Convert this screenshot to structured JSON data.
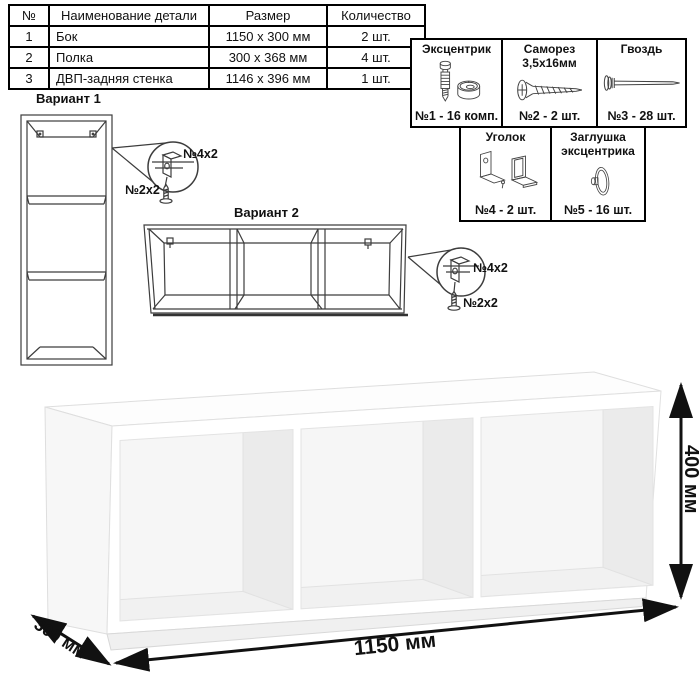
{
  "parts_table": {
    "headers": [
      "№",
      "Наименование детали",
      "Размер",
      "Количество"
    ],
    "rows": [
      {
        "num": "1",
        "name": "Бок",
        "size": "1150 x 300 мм",
        "qty": "2 шт."
      },
      {
        "num": "2",
        "name": "Полка",
        "size": "300 x 368 мм",
        "qty": "4 шт."
      },
      {
        "num": "3",
        "name": "ДВП-задняя стенка",
        "size": "1146 x 396 мм",
        "qty": "1 шт."
      }
    ]
  },
  "hardware": {
    "items": [
      {
        "title": "Эксцентрик",
        "count": "№1 - 16 комп.",
        "icon": "cam-bolt-icon"
      },
      {
        "title": "Саморез\n3,5х16мм",
        "count": "№2 - 2 шт.",
        "icon": "screw-icon"
      },
      {
        "title": "Гвоздь",
        "count": "№3 - 28 шт.",
        "icon": "nail-icon"
      },
      {
        "title": "Уголок",
        "count": "№4 - 2 шт.",
        "icon": "corner-bracket-icon"
      },
      {
        "title": "Заглушка\nэксцентрика",
        "count": "№5 - 16 шт.",
        "icon": "cam-cover-icon"
      }
    ]
  },
  "variants": {
    "variant1": {
      "label": "Вариант 1",
      "callout_bracket": "№4х2",
      "callout_screw": "№2х2"
    },
    "variant2": {
      "label": "Вариант 2",
      "callout_bracket": "№4х2",
      "callout_screw": "№2х2"
    }
  },
  "dimensions": {
    "width": "1150 мм",
    "height": "400 мм",
    "depth": "300 мм"
  },
  "colors": {
    "ink": "#111111",
    "line_art": "#3d3d3d",
    "table_border": "#000000"
  }
}
